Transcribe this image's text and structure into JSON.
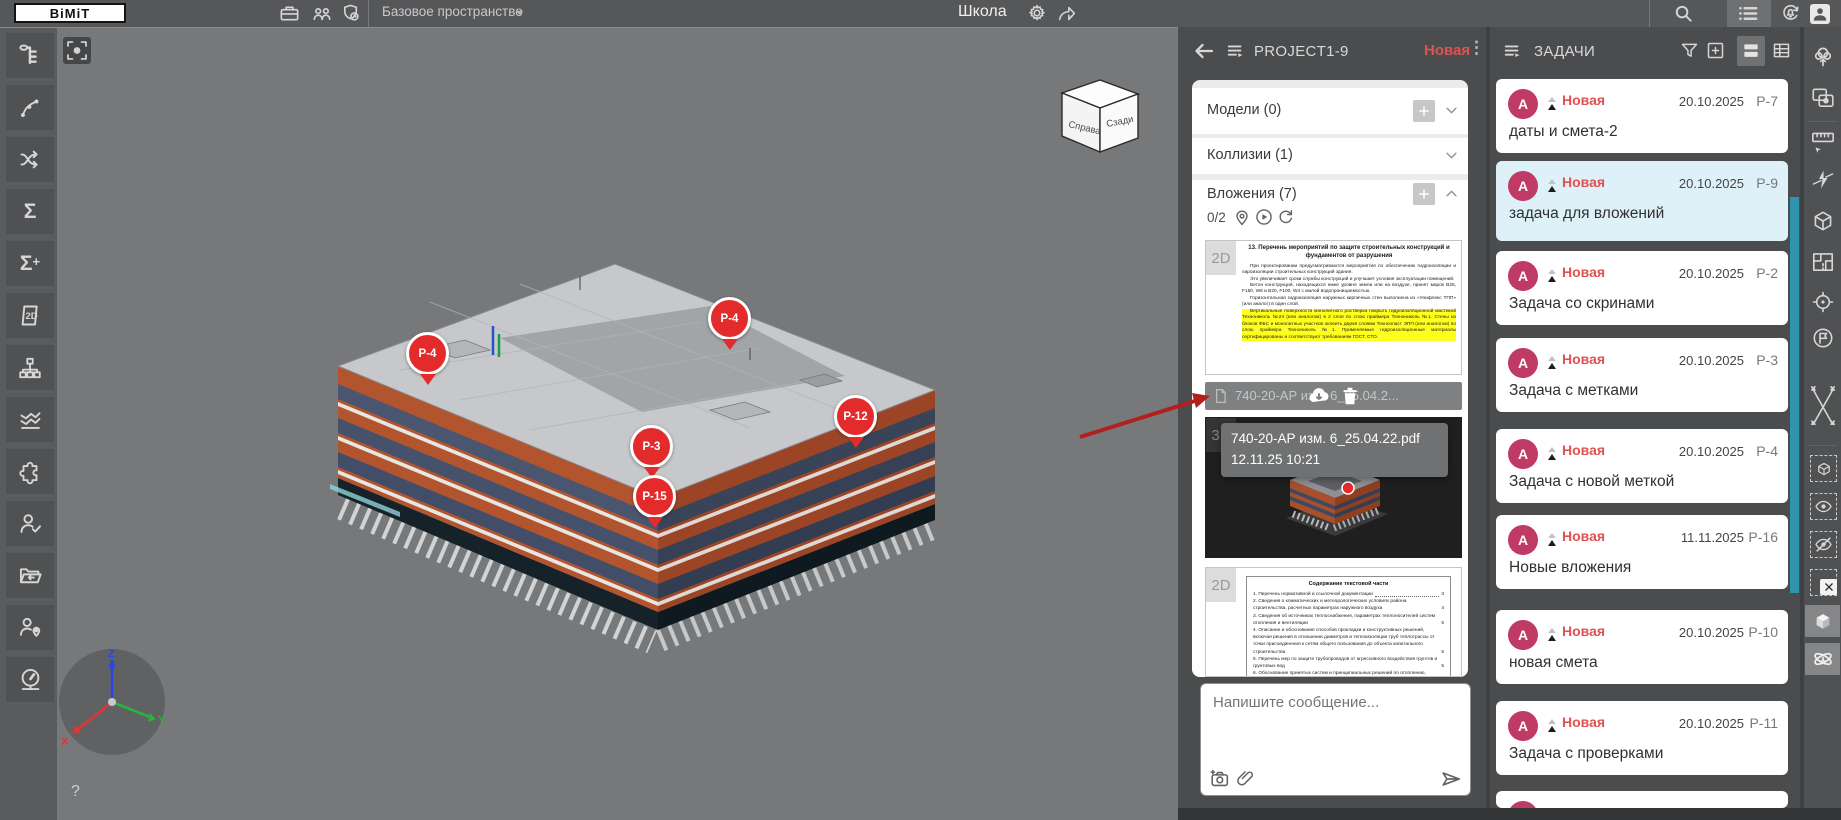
{
  "colors": {
    "accent_teal": "#2e95ac",
    "status_red": "#df5252",
    "avatar_pink": "#bf3a64",
    "marker_red": "#e32b2b",
    "highlight_card": "#def1f8",
    "annotation_arrow": "#b21f1f",
    "highlight_yellow": "#ffff1e",
    "topbar": "#565758",
    "panel": "#4b4c4d"
  },
  "topbar": {
    "logo": "BiMiT",
    "workspace": "Базовое пространство",
    "title": "Школа",
    "icons": [
      "briefcase-icon",
      "team-icon",
      "shield-clock-icon",
      "gear-icon",
      "share-icon",
      "search-icon",
      "list-menu-icon",
      "bell-sync-icon",
      "user-icon"
    ]
  },
  "left_toolbar": {
    "icons": [
      "model-tree",
      "nodes",
      "connections",
      "sum",
      "sum-add",
      "sheet-2d",
      "structure",
      "charts",
      "plugins",
      "user-check",
      "export-folder",
      "user-location",
      "dashboard"
    ],
    "sum_glyph": "Σ",
    "sum_add_glyph": "Σ+",
    "sheet_glyph": "2D"
  },
  "viewport": {
    "cube": {
      "left_face": "Справа",
      "right_face": "Сзади"
    },
    "axes": {
      "x": "X",
      "y": "Y",
      "z": "Z"
    },
    "help": "?",
    "markers": [
      {
        "id": "P-4"
      },
      {
        "id": "P-4"
      },
      {
        "id": "P-3"
      },
      {
        "id": "P-12"
      },
      {
        "id": "P-15"
      }
    ]
  },
  "chat": {
    "title": "PROJECT1-9",
    "status": "Новая",
    "sections": {
      "models": "Модели (0)",
      "collisions": "Коллизии (1)",
      "attachments": "Вложения (7)"
    },
    "counter": "0/2",
    "doc1": {
      "badge": "2D",
      "title": "13.  Перечень мероприятий по защите строительных конструкций и фундаментов от разрушения",
      "p1": "При проектировании предусматриваются мероприятия по обеспечению гидроизоляции и пароизоляции строительных конструкций здания.",
      "p2": "Это увеличивает сроки службы конструкций и улучшает условия эксплуатации помещений.",
      "p3": "Бетон конструкций, находящихся ниже уровня земли или на воздухе, принят марок В25, F150, W6 и В20, F100, W4 с малой водопроницаемостью.",
      "p4": "Горизонтальная гидроизоляция наружных кирпичных стен выполнена из «Унифлекс ТПП» (или аналог) в один слой.",
      "hl": "Вертикальные поверхности монолитного ростверка покрыть гидроизоляционной мастикой Технониколь №24 (или аналогом) в 2 слоя по слою праймера Технониколь №1. Стены из блоков ФБС и монолитных участков оклеить двумя слоями Техноэласт ЭПП (или аналогом) по слою праймера Технониколь №1. Применяемые гидроизоляционные материалы сертифицированы и соответствуют требованиям ГОСТ, СТО."
    },
    "file": {
      "name": "740-20-АР изм. 6_25.04.2..."
    },
    "tooltip": {
      "name": "740-20-АР изм. 6_25.04.22.pdf",
      "time": "12.11.25 10:21"
    },
    "view3d": {
      "badge": "3D"
    },
    "doc2": {
      "badge": "2D",
      "title": "Содержание текстовой части",
      "toc": [
        {
          "t": "1. Перечень нормативной и ссылочной документации",
          "p": "3"
        },
        {
          "t": "2. Сведения о климатических и метеорологических условиях района строительства, расчетных параметрах наружного воздуха",
          "p": "4"
        },
        {
          "t": "3. Сведения об источниках теплоснабжения, параметрах теплоносителей систем отопления и вентиляции",
          "p": "5"
        },
        {
          "t": "4. Описание и обоснование способов прокладки и конструктивных решений, включая решения в отношении диаметров и теплоизоляции труб теплотрассы от точки присоединения к сетям общего пользования до объекта капитального строительства",
          "p": "5"
        },
        {
          "t": "5. Перечень мер по защите трубопроводов от агрессивного воздействия грунтов и грунтовых вод",
          "p": "5"
        },
        {
          "t": "6. Обоснование принятых систем и принципиальных решений по отоплению, вентиляции и",
          "p": ""
        }
      ]
    },
    "composer": {
      "placeholder": "Напишите сообщение..."
    }
  },
  "tasks": {
    "title": "ЗАДАЧИ",
    "items": [
      {
        "a": "A",
        "s": "Новая",
        "d": "20.10.2025",
        "id": "P-7",
        "t": "даты и смета-2"
      },
      {
        "a": "A",
        "s": "Новая",
        "d": "20.10.2025",
        "id": "P-9",
        "t": "задача для вложений"
      },
      {
        "a": "A",
        "s": "Новая",
        "d": "20.10.2025",
        "id": "P-2",
        "t": "Задача со скринами"
      },
      {
        "a": "A",
        "s": "Новая",
        "d": "20.10.2025",
        "id": "P-3",
        "t": "Задача с метками"
      },
      {
        "a": "A",
        "s": "Новая",
        "d": "20.10.2025",
        "id": "P-4",
        "t": "Задача с новой меткой"
      },
      {
        "a": "A",
        "s": "Новая",
        "d": "11.11.2025",
        "id": "P-16",
        "t": "Новые вложения"
      },
      {
        "a": "A",
        "s": "Новая",
        "d": "20.10.2025",
        "id": "P-10",
        "t": "новая смета"
      },
      {
        "a": "A",
        "s": "Новая",
        "d": "20.10.2025",
        "id": "P-11",
        "t": "Задача с проверками"
      }
    ],
    "partial": {
      "a": "A"
    },
    "header_icons": [
      "filter-icon",
      "add-task-icon",
      "card-view-icon",
      "table-view-icon"
    ]
  },
  "right_strip": {
    "icons": [
      "environment-tree",
      "capture-region",
      "ruler",
      "section-plane",
      "section-box",
      "floor-plan",
      "locate-target",
      "flag",
      "measure-points",
      "isolate-box",
      "show-eye",
      "hide-eye",
      "clear-selection",
      "shaded-cube",
      "orbit"
    ]
  }
}
